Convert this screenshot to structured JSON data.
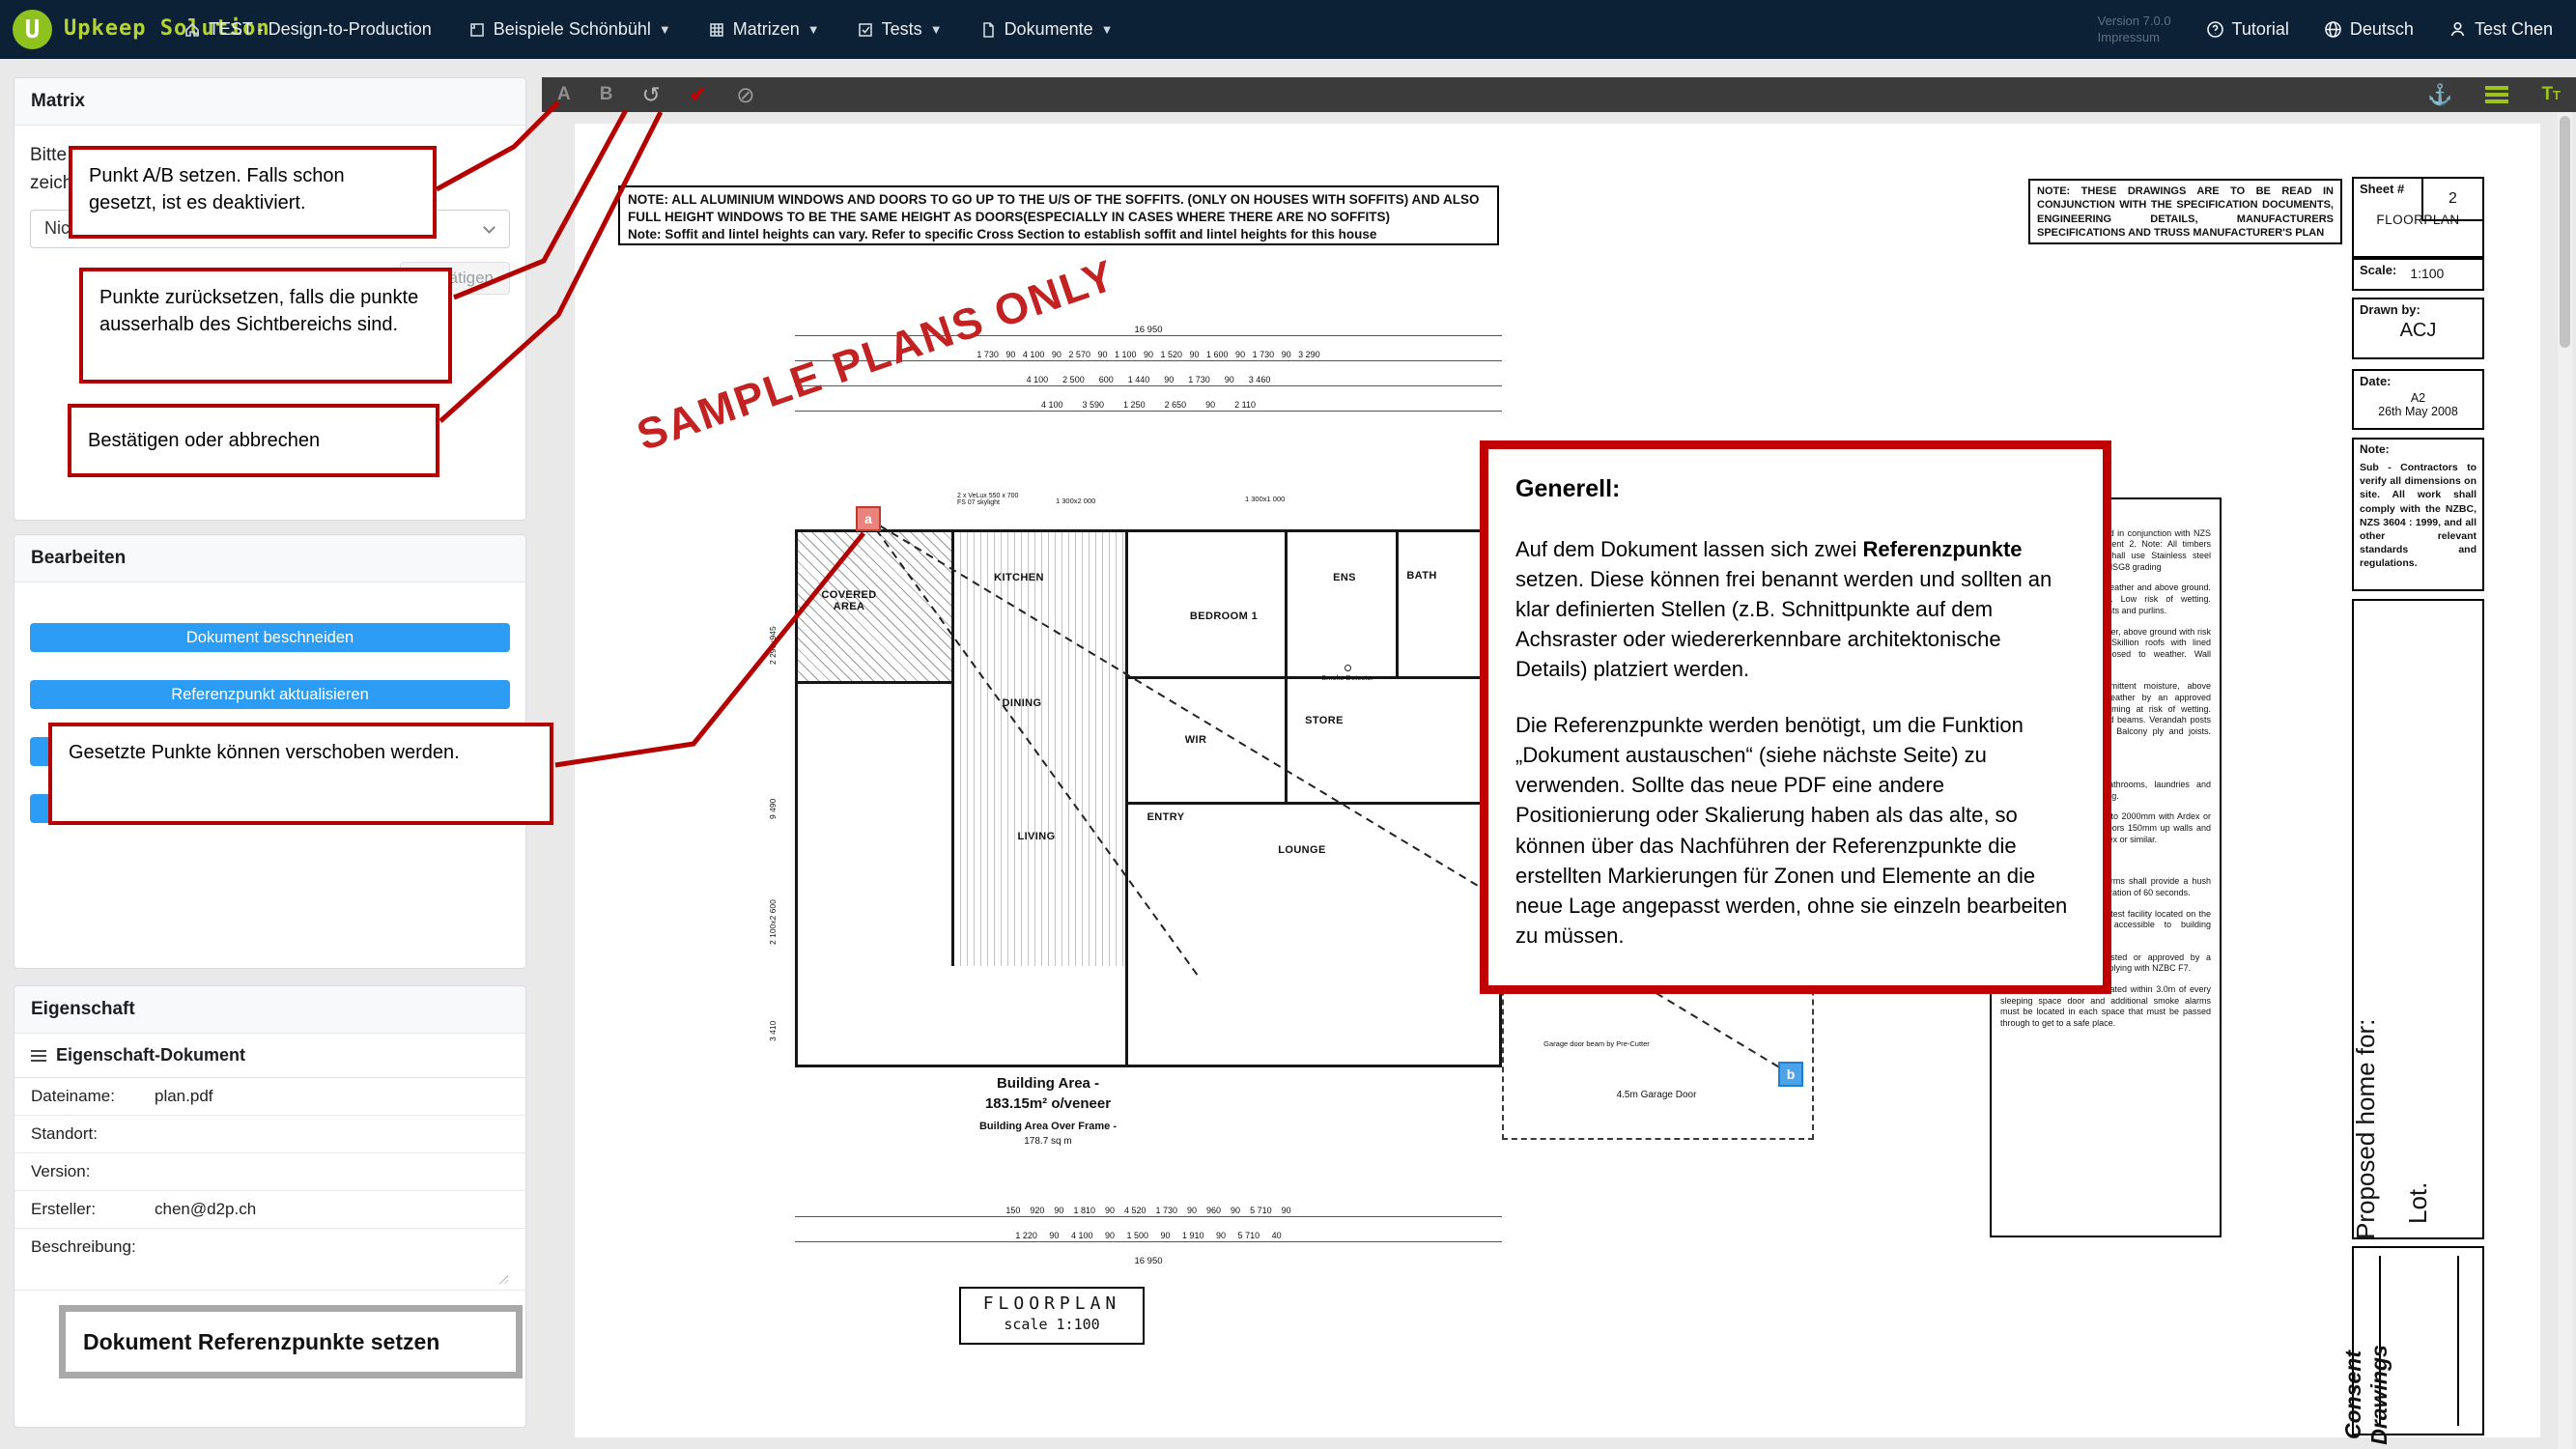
{
  "topbar": {
    "logo_letter": "U",
    "brand": "Upkeep Solution",
    "menu": [
      {
        "label": "TEST - Design-to-Production"
      },
      {
        "label": "Beispiele Schönbühl"
      },
      {
        "label": "Matrizen"
      },
      {
        "label": "Tests"
      },
      {
        "label": "Dokumente"
      }
    ],
    "version_line1": "Version 7.0.0",
    "version_line2": "Impressum",
    "tutorial": "Tutorial",
    "language": "Deutsch",
    "user": "Test Chen"
  },
  "toolbar": {
    "point_a": "A",
    "point_b": "B",
    "text_tool": "T"
  },
  "colors": {
    "brand_lime": "#8dc21f",
    "topbar_bg": "#0d2136",
    "accent_blue": "#2d9cf4",
    "callout_red": "#b40000",
    "toolbar_bg": "#3b3b3b"
  },
  "sidebar": {
    "matrix": {
      "title": "Matrix",
      "instruction_line1": "Bitte wählen Sie die Matrize und Elemente zu",
      "instruction_line2": "zeichnen.",
      "select_value": "Nichts ausgewählt",
      "confirm_button": "Bestätigen"
    },
    "edit": {
      "title": "Bearbeiten",
      "crop_button": "Dokument beschneiden",
      "refpoint_button": "Referenzpunkt aktualisieren"
    },
    "props": {
      "title": "Eigenschaft",
      "section": "Eigenschaft-Dokument",
      "rows": [
        {
          "label": "Dateiname:",
          "value": "plan.pdf"
        },
        {
          "label": "Standort:",
          "value": ""
        },
        {
          "label": "Version:",
          "value": ""
        },
        {
          "label": "Ersteller:",
          "value": "chen@d2p.ch"
        },
        {
          "label": "Beschreibung:",
          "value": ""
        }
      ],
      "frame_title": "Dokument Referenzpunkte setzen"
    }
  },
  "callouts": {
    "c1": "Punkt A/B setzen. Falls schon gesetzt, ist es deaktiviert.",
    "c2": "Punkte zurücksetzen, falls die punkte ausserhalb des Sichtbereichs sind.",
    "c3": "Bestätigen oder abbrechen",
    "c4": "Gesetzte Punkte können verschoben werden."
  },
  "generell": {
    "title": "Generell:",
    "p1_pre": "Auf dem Dokument lassen sich zwei ",
    "p1_bold": "Referenzpunkte",
    "p1_post": " setzen. Diese können frei benannt werden und sollten an klar definierten Stellen (z.B. Schnittpunkte auf dem Achsraster oder wiedererkennbare architektonische Details) platziert werden.",
    "p2": "Die Referenzpunkte werden benötigt, um die Funktion „Dokument austauschen“ (siehe nächste Seite) zu verwenden. Sollte das neue PDF eine andere Positionierung oder Skalierung haben als das alte, so können über das Nachführen der Referenzpunkte die erstellten Markierungen für Zonen und Elemente an die neue Lage angepasst werden, ohne sie einzeln bearbeiten zu müssen."
  },
  "plan": {
    "stamp": "SAMPLE PLANS ONLY",
    "top_note_1": "NOTE: ALL ALUMINIUM WINDOWS AND DOORS TO GO UP TO THE U/S OF THE SOFFITS. (ONLY ON HOUSES WITH SOFFITS) AND ALSO FULL HEIGHT WINDOWS TO BE THE SAME HEIGHT AS DOORS(ESPECIALLY IN CASES WHERE THERE ARE NO SOFFITS)",
    "top_note_2": "Note: Soffit and lintel heights can vary. Refer to specific Cross Section to establish soffit and lintel heights for this house",
    "right_note": "NOTE: THESE DRAWINGS ARE TO BE READ IN CONJUNCTION WITH THE SPECIFICATION DOCUMENTS, ENGINEERING DETAILS, MANUFACTURERS SPECIFICATIONS AND TRUSS MANUFACTURER'S PLAN",
    "titleblock": {
      "sheet_label": "Sheet #",
      "sheet_number": "2",
      "title": "FLOORPLAN",
      "scale_label": "Scale:",
      "scale_value": "1:100",
      "drawn_label": "Drawn by:",
      "drawn_value": "ACJ",
      "date_label": "Date:",
      "date_value1": "A2",
      "date_value2": "26th May 2008",
      "note_label": "Note:",
      "note_text": "Sub - Contractors to verify all dimensions on site. All work shall comply with the NZBC, NZS 3604 : 1999, and all other relevant standards and regulations.",
      "proposed": "Proposed home for:",
      "lot": "Lot.",
      "consent_line1": "Consent",
      "consent_line2": "Drawings"
    },
    "spec": {
      "items": [
        "TIMBER TREATMENT",
        "All timber framing to be read in conjunction with NZS 3604 : 1999 and Amendment 2. Note: All timbers treated to H3 or above shall use Stainless steel fixings. All grading shall be MSG8 grading",
        "H1.2 - Protected from the weather and above ground. Roof and ceiling framing. Low risk of wetting. Intermediate interior floor joists and purlins.",
        "H1.2 - Exposed to the weather, above ground with risk of exposure to moisture. Skillion roofs with lined soffits. Exterior walls exposed to weather. Wall framing.",
        "H3.1 - Exposed to intermittent moisture, above ground, protected from weather by an approved coating. Wall and floor framing at risk of wetting. Primed or painted posts and beams. Verandah posts supporting enclosed decks. Balcony ply and joists. Balustrade framing.",
        "WET AREA TREATMENT",
        "All wet area floors to bathrooms, laundries and kitchen's to have H3.1 flooring.",
        "Tank all shower enclosures to 2000mm with Ardex or similar. Tank all wet area floors 150mm up walls and 150mm above bath with Ardex or similar.",
        "SMOKE DETECTORS",
        "Battery powered smoke alarms shall provide a hush facility having a minimum duration of 60 seconds.",
        "Smoke alarms shall have a test facility located on the smoke alarm ( readily accessible to building occupants).",
        "Smoke alarms shall be listed or approved by a recognized authority as complying with NZBC F7.",
        "A smoke alarm must be located within 3.0m of every sleeping space door and additional smoke alarms must be located in each space that must be passed through to get to a safe place."
      ]
    },
    "rooms": [
      "COVERED AREA",
      "KITCHEN",
      "BEDROOM 1",
      "ENS",
      "BATH",
      "DINING",
      "WIR",
      "STORE",
      "LIVING",
      "ENTRY",
      "LOUNGE"
    ],
    "labels": {
      "smoke": "Smoke Detector",
      "garage_door": "4.5m Garage Door",
      "garage_beam": "Garage door beam by Pre-Cutter",
      "window1": "1 300x2 000",
      "window2": "1 300x1 000",
      "skylight1": "2 x VeLux 550 x 700",
      "skylight2": "FS 07 skylight",
      "area1": "Building Area -",
      "area2": "183.15m² o/veneer",
      "area3": "Building Area Over Frame -",
      "area4": "178.7 sq m",
      "fp1": "FLOORPLAN",
      "fp2": "scale 1:100"
    },
    "dims": {
      "top_total": "16 950",
      "top_row1": [
        "1 730",
        "90",
        "4 100",
        "90",
        "2 570",
        "90",
        "1 100",
        "90",
        "1 520",
        "90",
        "1 600",
        "90",
        "1 730",
        "90",
        "3 290"
      ],
      "top_row2": [
        "4 100",
        "2 500",
        "600",
        "1 440",
        "90",
        "1 730",
        "90",
        "3 460"
      ],
      "top_row3": [
        "4 100",
        "3 590",
        "1 250",
        "2 650",
        "90",
        "2 110"
      ],
      "bottom_row1": [
        "150",
        "920",
        "90",
        "1 810",
        "90",
        "4 520",
        "1 730",
        "90",
        "960",
        "90",
        "5 710",
        "90"
      ],
      "bottom_row2": [
        "1 220",
        "90",
        "4 100",
        "90",
        "1 500",
        "90",
        "1 910",
        "90",
        "5 710",
        "40"
      ],
      "bottom_total": "16 950",
      "left_col": [
        "2 290x945",
        "9 490",
        "2 100x2 600",
        "3 410"
      ]
    },
    "markers": {
      "a": "a",
      "b": "b"
    }
  }
}
